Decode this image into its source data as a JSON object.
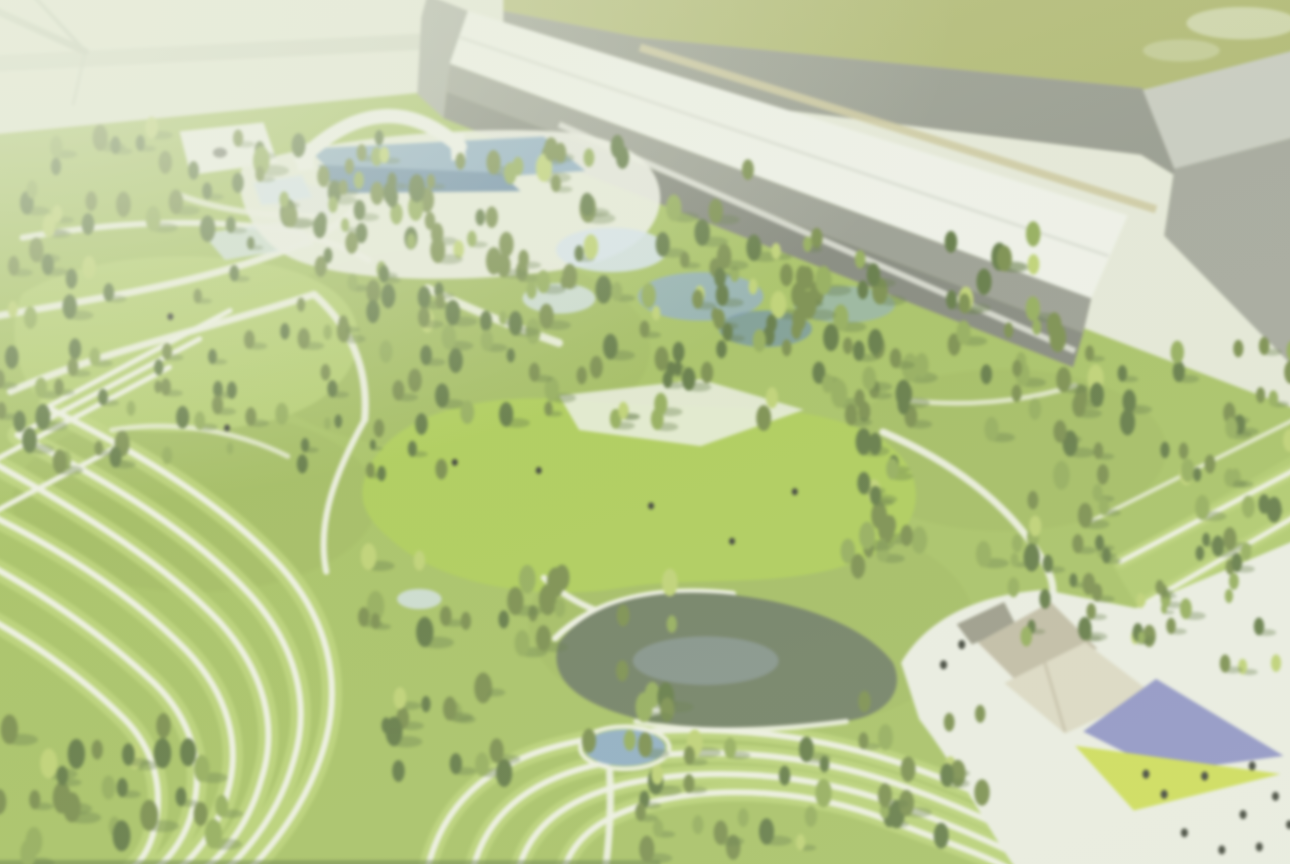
{
  "scene": {
    "title": "Aerial rendering of a landscaped park masterplan with terraced lawns, conifer groves, water features and an event plaza, bordered by long industrial halls",
    "view": "aerial-oblique",
    "style": "soft-focus architectural visualization with pale haze"
  },
  "palette": {
    "backdrop": "#e2e5d4",
    "backdrop_line": "#b7bead",
    "wall_band": "#cdd2c0",
    "field": "#a6b05f",
    "road": "#8a8e82",
    "road_shoulder": "#c7c092",
    "roof_white": "#edefe7",
    "roof_ridge": "#d4d7cd",
    "facade_upper": "#8e9186",
    "facade_lower": "#75786e",
    "end_wall": "#9ca096",
    "bldg2_top": "#c1c4ba",
    "bldg2_front": "#999c91",
    "grass_base": "#9cba4e",
    "grass_light": "#aac75a",
    "lawn_bright": "#a2c63f",
    "terrace_grass": "#b4cf66",
    "path": "#edefe1",
    "water_blue": "#7fa3c0",
    "water_deep": "#597fa2",
    "water_pale": "#cfdfeb",
    "pond_dark": "#5d6d50",
    "pond_sheen": "#8496a0",
    "tree_dark": "#4c672c",
    "tree_mid": "#677e34",
    "tree_light": "#85a243",
    "tree_highlight": "#b6cc5f",
    "plaza_white": "#eaece2",
    "canopy_beige": "#bab29a",
    "canopy_cream": "#d9d4be",
    "canopy_gray": "#8e8c7b",
    "paving_purple": "#8084c5",
    "paving_yellow": "#c9da3c",
    "people": "#22271e",
    "smoke": "#e3e9d4"
  },
  "regions": [
    {
      "id": "backdrop",
      "desc": "Pale hazy backdrop beyond the park, upper-left corner, with thin diagonal edge lines"
    },
    {
      "id": "meadow-field",
      "desc": "Olive-green meadow beyond the road along the top edge"
    },
    {
      "id": "access-road",
      "desc": "Gray perimeter road running diagonally along the top"
    },
    {
      "id": "main-building",
      "desc": "Long gray industrial hall with white roof and tan gutter stripe along the north edge"
    },
    {
      "id": "secondary-building",
      "desc": "Smaller gray hall box at the northeast corner"
    },
    {
      "id": "park-ground",
      "desc": "Rolling green park lawn covering most of the frame"
    },
    {
      "id": "north-pond-building",
      "desc": "Small white pavilion with blue ponds nestled in trees, upper left"
    },
    {
      "id": "aquatic-complex",
      "desc": "Pool complex with white arch canopy, decks and cascading blue ponds, upper center"
    },
    {
      "id": "upper-lawn",
      "desc": "Open lawn clearing crossed by paths, mid left"
    },
    {
      "id": "central-lawn",
      "desc": "Large bright central great lawn"
    },
    {
      "id": "terraces-west",
      "desc": "Nested curved terraced-lawn paths sweeping through the southwest"
    },
    {
      "id": "terraces-south",
      "desc": "Curved terraced-lawn paths arcing along the bottom"
    },
    {
      "id": "slope-stripes-east",
      "desc": "Parallel white path stripes on the southeast slope"
    },
    {
      "id": "south-pond",
      "desc": "Dark reflecting pond with white rim, lower center"
    },
    {
      "id": "small-pond",
      "desc": "Small bright blue pond below the reflecting pond"
    },
    {
      "id": "event-plaza",
      "desc": "White event plaza in the lower right with angular shade canopies"
    },
    {
      "id": "paving-purple-panel",
      "desc": "Purple diamond paving panel on the plaza"
    },
    {
      "id": "paving-yellow-panel",
      "desc": "Yellow-green triangular paving panel on the plaza"
    },
    {
      "id": "walkways",
      "desc": "White pedestrian paths winding through the park"
    },
    {
      "id": "trees",
      "desc": "Dense conifer and broadleaf groves with cast shadows pointing east"
    },
    {
      "id": "people",
      "desc": "Tiny visitor figures dotted on the plaza and lawns"
    },
    {
      "id": "smoke-wisp",
      "desc": "Faint pale wisp over the meadow, top right"
    }
  ],
  "vegetation": {
    "clusters": [
      {
        "id": "north-treeline-west",
        "x": 0,
        "y": 128,
        "w": 390,
        "h": 120,
        "n": 38,
        "rmin": 6,
        "rmax": 11
      },
      {
        "id": "north-treeline-mid",
        "x": 380,
        "y": 150,
        "w": 370,
        "h": 150,
        "n": 42,
        "rmin": 6,
        "rmax": 11
      },
      {
        "id": "north-treeline-east",
        "x": 740,
        "y": 225,
        "w": 360,
        "h": 175,
        "n": 42,
        "rmin": 6,
        "rmax": 11
      },
      {
        "id": "northeast-grove",
        "x": 1085,
        "y": 330,
        "w": 205,
        "h": 180,
        "n": 26,
        "rmin": 6,
        "rmax": 10
      },
      {
        "id": "west-edge-grove",
        "x": 0,
        "y": 250,
        "w": 140,
        "h": 220,
        "n": 24,
        "rmin": 6,
        "rmax": 10
      },
      {
        "id": "southwest-corner",
        "x": 0,
        "y": 720,
        "w": 240,
        "h": 140,
        "n": 26,
        "rmin": 7,
        "rmax": 12
      },
      {
        "id": "upper-water-grove",
        "x": 225,
        "y": 140,
        "w": 210,
        "h": 140,
        "n": 20,
        "rmin": 5,
        "rmax": 9
      },
      {
        "id": "central-west-grove",
        "x": 320,
        "y": 225,
        "w": 190,
        "h": 170,
        "n": 22,
        "rmin": 5,
        "rmax": 10
      },
      {
        "id": "mid-west-grove",
        "x": 170,
        "y": 295,
        "w": 170,
        "h": 130,
        "n": 16,
        "rmin": 5,
        "rmax": 9
      },
      {
        "id": "central-grove",
        "x": 420,
        "y": 275,
        "w": 260,
        "h": 150,
        "n": 30,
        "rmin": 5,
        "rmax": 10
      },
      {
        "id": "central-east-grove",
        "x": 650,
        "y": 245,
        "w": 260,
        "h": 175,
        "n": 32,
        "rmin": 5,
        "rmax": 10
      },
      {
        "id": "east-grove",
        "x": 845,
        "y": 330,
        "w": 270,
        "h": 235,
        "n": 44,
        "rmin": 6,
        "rmax": 11
      },
      {
        "id": "south-central-grove",
        "x": 355,
        "y": 555,
        "w": 335,
        "h": 225,
        "n": 44,
        "rmin": 6,
        "rmax": 12
      },
      {
        "id": "south-grove",
        "x": 615,
        "y": 735,
        "w": 210,
        "h": 120,
        "n": 20,
        "rmin": 6,
        "rmax": 11
      },
      {
        "id": "plaza-west-grove",
        "x": 855,
        "y": 695,
        "w": 150,
        "h": 150,
        "n": 16,
        "rmin": 6,
        "rmax": 11
      },
      {
        "id": "lawn-scatter",
        "x": 95,
        "y": 360,
        "w": 250,
        "h": 120,
        "n": 10,
        "rmin": 4,
        "rmax": 8
      },
      {
        "id": "lawn-edge-scatter",
        "x": 330,
        "y": 395,
        "w": 150,
        "h": 95,
        "n": 8,
        "rmin": 4,
        "rmax": 8
      },
      {
        "id": "east-edge-grove",
        "x": 1175,
        "y": 455,
        "w": 115,
        "h": 130,
        "n": 12,
        "rmin": 5,
        "rmax": 9
      },
      {
        "id": "plaza-north-grove",
        "x": 990,
        "y": 530,
        "w": 190,
        "h": 110,
        "n": 18,
        "rmin": 5,
        "rmax": 9
      },
      {
        "id": "plaza-east-palms",
        "x": 1150,
        "y": 575,
        "w": 130,
        "h": 95,
        "n": 8,
        "rmin": 4,
        "rmax": 8
      },
      {
        "id": "southeast-scatter",
        "x": 1060,
        "y": 560,
        "w": 120,
        "h": 80,
        "n": 6,
        "rmin": 4,
        "rmax": 7
      }
    ]
  },
  "people": {
    "plaza": [
      [
        1158,
        790
      ],
      [
        1198,
        772
      ],
      [
        1245,
        762
      ],
      [
        1268,
        792
      ],
      [
        1236,
        810
      ],
      [
        1178,
        828
      ],
      [
        1252,
        842
      ],
      [
        1282,
        820
      ],
      [
        1140,
        770
      ],
      [
        1215,
        845
      ],
      [
        958,
        642
      ],
      [
        940,
        662
      ]
    ],
    "lawn": [
      [
        457,
        462
      ],
      [
        651,
        505
      ],
      [
        793,
        491
      ],
      [
        731,
        540
      ],
      [
        176,
        318
      ],
      [
        540,
        470
      ],
      [
        232,
        428
      ]
    ]
  }
}
